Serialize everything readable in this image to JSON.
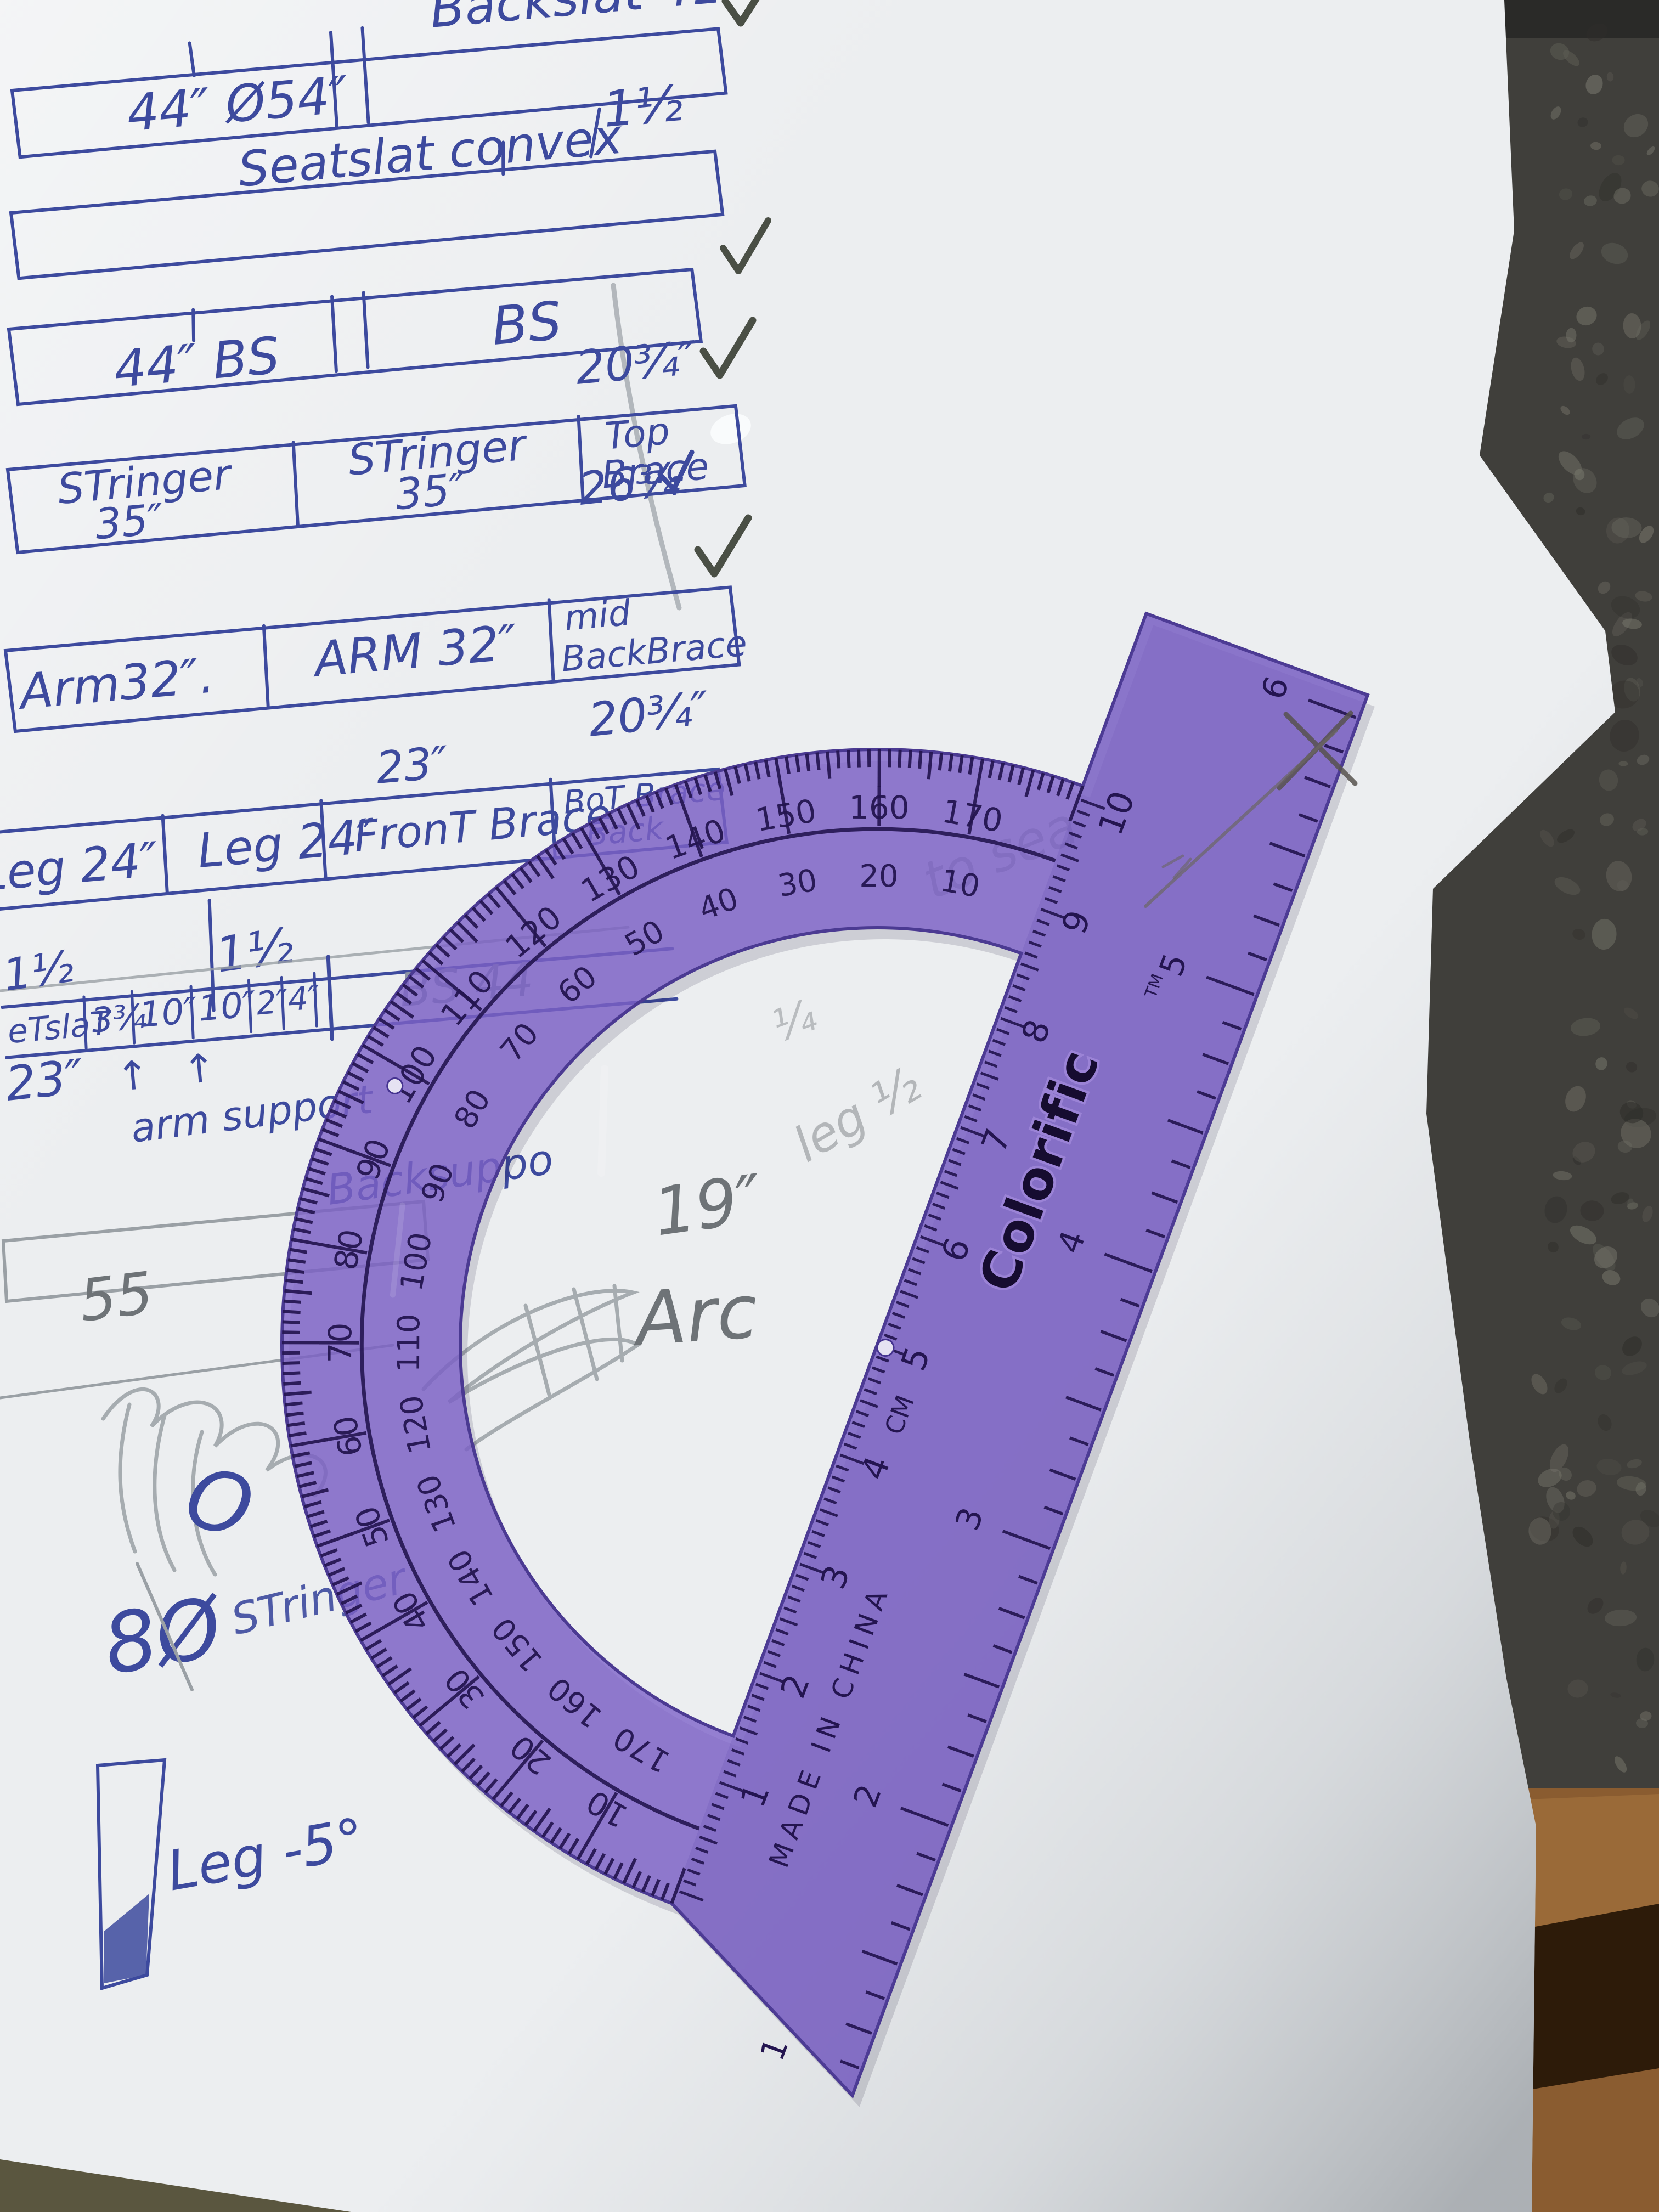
{
  "meta": {
    "description": "Photograph of hand-drawn woodworking cut-list sketches in blue ink and pencil on white paper, with a translucent purple Colorific protractor lying on the lower right of the sheet. Dark granite counter visible along the right edge, wood surface at lower right."
  },
  "colors": {
    "ink": "#3d4a9e",
    "pencil": "#8f959b",
    "protractor_purple": "#7e63c9",
    "protractor_print": "#241550",
    "paper": "#eceef0",
    "granite": "#403f3b",
    "wood": "#8a5c30",
    "olive": "#5a563f",
    "checkmark": "#4a4f45"
  },
  "notes": {
    "backslat_label": "Backslat 41",
    "row_a_cell": "44″ Ø54″",
    "seatslat_label": "Seatslat convex",
    "seatslat_dim": "1½",
    "row_c_left": "44″ BS",
    "row_c_right": "BS",
    "dim_top_brace": "20¾″",
    "stringer_1a": "STringer",
    "stringer_1b": "35″",
    "stringer_2a": "STringer",
    "stringer_2b": "35″",
    "stringer_3a": "Top",
    "stringer_3b": "Brace",
    "dim_mid_back": "26¾",
    "arm_1": "Arm32″.",
    "arm_2": "ARM 32″",
    "arm_3a": "mid",
    "arm_3b": "BackBrace",
    "dim_front_brace": "23″",
    "dim_bot_brace": "20¾″",
    "leg_1": "Leg 24″",
    "leg_2": "Leg 24″",
    "leg_3": "FronT Brace",
    "leg_4a": "BoT Brace",
    "leg_4b": "Back",
    "dim_one_half": "1½",
    "strip_left": "1½",
    "strip_t1": "eTslaT",
    "strip_t2": "3¾",
    "strip_t3": "10″",
    "strip_t4": "10″",
    "strip_t5": "2″",
    "strip_t6": "4″",
    "strip_arrow": "↑",
    "strip_pencil": "BS 44",
    "note_23": "23″",
    "note_arm_support": "arm support",
    "note_back_support": "Backsuppo",
    "pencil_55": "55",
    "note_o": "O",
    "note_80": "8Ø",
    "note_stringer_partial": "STringer",
    "note_leg": "Leg -5°",
    "pencil_19": "19″",
    "pencil_arc": "Arc",
    "ghost_1": "to sea",
    "ghost_2": "leg ½",
    "ghost_3": "¼"
  },
  "protractor": {
    "brand": "Colorific",
    "brand_tm": "TM",
    "made_in": "MADE IN CHINA",
    "cm_label": "CM",
    "outer_scale": [
      10,
      20,
      30,
      40,
      50,
      60,
      70,
      80,
      90,
      100,
      110,
      120,
      130,
      140,
      150,
      160,
      170
    ],
    "inner_scale": [
      170,
      160,
      150,
      140,
      130,
      120,
      110,
      100,
      90,
      80,
      70,
      60,
      50,
      40,
      30,
      20,
      10
    ],
    "cm_numbers": [
      1,
      2,
      3,
      4,
      5,
      6,
      7,
      8,
      9,
      10
    ],
    "inch_numbers": [
      1,
      2,
      3,
      4,
      5,
      6
    ]
  }
}
